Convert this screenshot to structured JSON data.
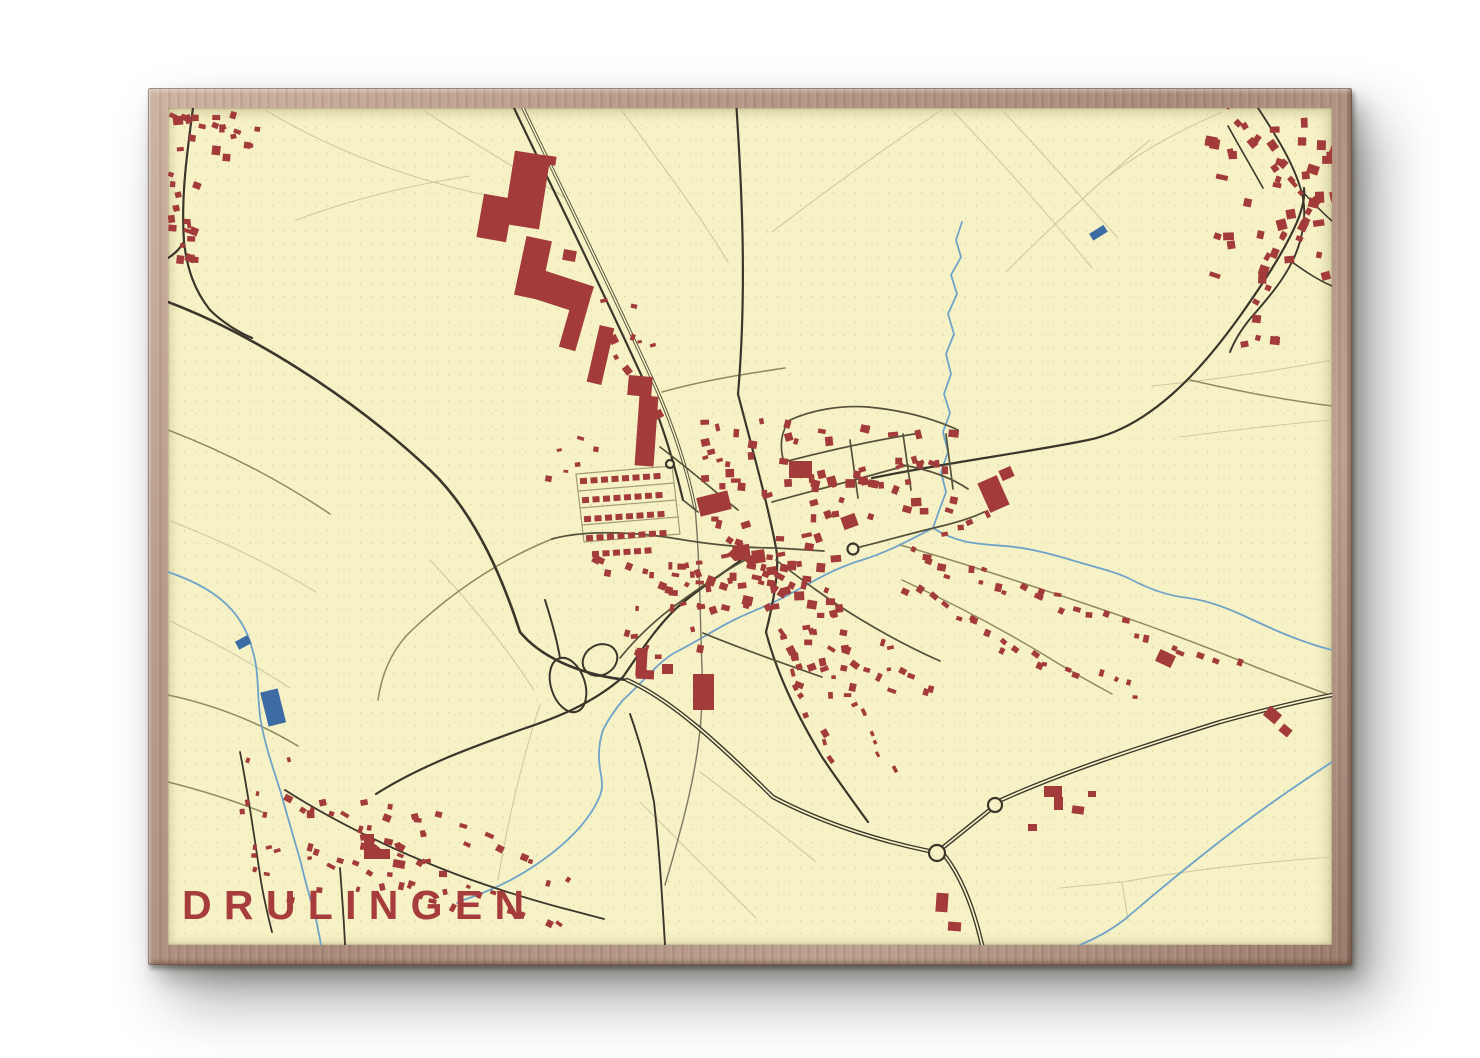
{
  "scene": {
    "background_color": "#ffffff"
  },
  "poster": {
    "title": "DRULINGEN",
    "title_color": "#a63d3c",
    "frame_color": "#b49685",
    "paper_color": "#f6f2c6"
  },
  "map": {
    "colors": {
      "building": "#a23b3a",
      "water": "#6fa3c8",
      "pond": "#3d6ca5",
      "road_major": "#3a362b",
      "road_medium": "#55503a",
      "road_minor": "#8f8a5e",
      "field_line": "#cfc9a0",
      "railway": "#7b7660"
    },
    "building_blocks": [
      {
        "x": 480,
        "y": 196,
        "w": 30,
        "h": 44,
        "r": 10
      },
      {
        "x": 509,
        "y": 153,
        "w": 36,
        "h": 74,
        "r": 9
      },
      {
        "x": 520,
        "y": 238,
        "w": 26,
        "h": 60,
        "r": 12
      },
      {
        "x": 527,
        "y": 276,
        "w": 64,
        "h": 30,
        "r": 18
      },
      {
        "x": 566,
        "y": 296,
        "w": 17,
        "h": 54,
        "r": 16
      },
      {
        "x": 593,
        "y": 326,
        "w": 15,
        "h": 58,
        "r": 13
      },
      {
        "x": 628,
        "y": 376,
        "w": 24,
        "h": 20,
        "r": 5
      },
      {
        "x": 637,
        "y": 396,
        "w": 19,
        "h": 70,
        "r": 4
      },
      {
        "x": 545,
        "y": 156,
        "w": 11,
        "h": 9,
        "r": 8
      },
      {
        "x": 563,
        "y": 250,
        "w": 13,
        "h": 11,
        "r": 10
      },
      {
        "x": 698,
        "y": 494,
        "w": 32,
        "h": 19,
        "r": -14
      },
      {
        "x": 693,
        "y": 674,
        "w": 21,
        "h": 36,
        "r": 0
      },
      {
        "x": 789,
        "y": 461,
        "w": 23,
        "h": 17,
        "r": 0
      },
      {
        "x": 842,
        "y": 515,
        "w": 15,
        "h": 13,
        "r": -20
      },
      {
        "x": 983,
        "y": 478,
        "w": 21,
        "h": 32,
        "r": -24
      },
      {
        "x": 1000,
        "y": 468,
        "w": 13,
        "h": 11,
        "r": -24
      },
      {
        "x": 1157,
        "y": 652,
        "w": 17,
        "h": 13,
        "r": 25
      },
      {
        "x": 1265,
        "y": 709,
        "w": 15,
        "h": 12,
        "r": 40
      },
      {
        "x": 1280,
        "y": 726,
        "w": 11,
        "h": 9,
        "r": 40
      },
      {
        "x": 936,
        "y": 893,
        "w": 12,
        "h": 19,
        "r": 4
      },
      {
        "x": 948,
        "y": 922,
        "w": 13,
        "h": 9,
        "r": 4
      },
      {
        "x": 364,
        "y": 834,
        "w": 10,
        "h": 25,
        "r": 0
      },
      {
        "x": 364,
        "y": 849,
        "w": 26,
        "h": 10,
        "r": 0
      },
      {
        "x": 393,
        "y": 860,
        "w": 12,
        "h": 8,
        "r": 10
      },
      {
        "x": 1044,
        "y": 786,
        "w": 18,
        "h": 11,
        "r": 0
      },
      {
        "x": 1054,
        "y": 797,
        "w": 9,
        "h": 13,
        "r": 0
      },
      {
        "x": 1072,
        "y": 806,
        "w": 12,
        "h": 8,
        "r": 8
      },
      {
        "x": 1028,
        "y": 824,
        "w": 9,
        "h": 7,
        "r": 0
      },
      {
        "x": 1088,
        "y": 791,
        "w": 8,
        "h": 6,
        "r": 0
      },
      {
        "x": 733,
        "y": 545,
        "w": 17,
        "h": 15,
        "r": -8
      },
      {
        "x": 752,
        "y": 550,
        "w": 13,
        "h": 13,
        "r": -8
      },
      {
        "x": 636,
        "y": 648,
        "w": 11,
        "h": 28,
        "r": 3
      },
      {
        "x": 636,
        "y": 670,
        "w": 18,
        "h": 9,
        "r": 3
      },
      {
        "x": 662,
        "y": 664,
        "w": 11,
        "h": 10,
        "r": 0
      }
    ],
    "building_clusters": [
      {
        "x": 170,
        "y": 108,
        "w": 85,
        "h": 55,
        "n": 13,
        "s": 7
      },
      {
        "x": 168,
        "y": 170,
        "w": 38,
        "h": 95,
        "n": 11,
        "s": 6
      },
      {
        "x": 1205,
        "y": 108,
        "w": 140,
        "h": 180,
        "n": 38,
        "s": 8
      },
      {
        "x": 1238,
        "y": 296,
        "w": 55,
        "h": 55,
        "n": 5,
        "s": 7
      },
      {
        "x": 695,
        "y": 468,
        "w": 150,
        "h": 150,
        "n": 65,
        "s": 7
      },
      {
        "x": 700,
        "y": 418,
        "w": 110,
        "h": 52,
        "n": 15,
        "s": 6
      },
      {
        "x": 806,
        "y": 425,
        "w": 155,
        "h": 100,
        "n": 30,
        "s": 7
      },
      {
        "x": 655,
        "y": 545,
        "w": 52,
        "h": 108,
        "n": 13,
        "s": 6
      },
      {
        "x": 782,
        "y": 612,
        "w": 118,
        "h": 88,
        "n": 22,
        "s": 6
      },
      {
        "x": 282,
        "y": 798,
        "w": 180,
        "h": 108,
        "n": 26,
        "s": 6
      },
      {
        "x": 236,
        "y": 756,
        "w": 58,
        "h": 128,
        "n": 12,
        "s": 5
      },
      {
        "x": 618,
        "y": 598,
        "w": 62,
        "h": 62,
        "n": 6,
        "s": 5
      },
      {
        "x": 598,
        "y": 296,
        "w": 62,
        "h": 60,
        "n": 6,
        "s": 5
      },
      {
        "x": 545,
        "y": 435,
        "w": 60,
        "h": 50,
        "n": 6,
        "s": 5
      }
    ],
    "building_strips": [
      {
        "x1": 905,
        "y1": 552,
        "x2": 1055,
        "y2": 600,
        "n": 14,
        "s": 6,
        "j": 8
      },
      {
        "x1": 1055,
        "y1": 600,
        "x2": 1230,
        "y2": 660,
        "n": 12,
        "s": 6,
        "j": 8
      },
      {
        "x1": 905,
        "y1": 585,
        "x2": 1030,
        "y2": 655,
        "n": 12,
        "s": 6,
        "j": 8
      },
      {
        "x1": 1030,
        "y1": 660,
        "x2": 1140,
        "y2": 690,
        "n": 8,
        "s": 5,
        "j": 8
      },
      {
        "x1": 832,
        "y1": 648,
        "x2": 935,
        "y2": 692,
        "n": 9,
        "s": 6,
        "j": 8
      },
      {
        "x1": 770,
        "y1": 612,
        "x2": 828,
        "y2": 755,
        "n": 11,
        "s": 6,
        "j": 9
      },
      {
        "x1": 845,
        "y1": 700,
        "x2": 892,
        "y2": 760,
        "n": 6,
        "s": 5,
        "j": 8
      },
      {
        "x1": 285,
        "y1": 792,
        "x2": 430,
        "y2": 868,
        "n": 12,
        "s": 6,
        "j": 9
      },
      {
        "x1": 300,
        "y1": 848,
        "x2": 465,
        "y2": 903,
        "n": 12,
        "s": 6,
        "j": 9
      },
      {
        "x1": 435,
        "y1": 818,
        "x2": 560,
        "y2": 882,
        "n": 9,
        "s": 6,
        "j": 9
      },
      {
        "x1": 465,
        "y1": 882,
        "x2": 555,
        "y2": 928,
        "n": 7,
        "s": 5,
        "j": 8
      },
      {
        "x1": 172,
        "y1": 112,
        "x2": 252,
        "y2": 128,
        "n": 7,
        "s": 6,
        "j": 7
      },
      {
        "x1": 174,
        "y1": 180,
        "x2": 186,
        "y2": 262,
        "n": 8,
        "s": 5,
        "j": 7
      },
      {
        "x1": 1225,
        "y1": 108,
        "x2": 1302,
        "y2": 195,
        "n": 12,
        "s": 7,
        "j": 10
      },
      {
        "x1": 1302,
        "y1": 200,
        "x2": 1252,
        "y2": 298,
        "n": 11,
        "s": 7,
        "j": 10
      },
      {
        "x1": 585,
        "y1": 555,
        "x2": 690,
        "y2": 585,
        "n": 9,
        "s": 6,
        "j": 8
      },
      {
        "x1": 600,
        "y1": 330,
        "x2": 660,
        "y2": 420,
        "n": 7,
        "s": 6,
        "j": 10
      },
      {
        "x1": 870,
        "y1": 480,
        "x2": 930,
        "y2": 462,
        "n": 5,
        "s": 6,
        "j": 7
      },
      {
        "x1": 720,
        "y1": 540,
        "x2": 792,
        "y2": 590,
        "n": 12,
        "s": 7,
        "j": 9
      },
      {
        "x1": 940,
        "y1": 527,
        "x2": 985,
        "y2": 515,
        "n": 4,
        "s": 6,
        "j": 7
      }
    ],
    "building_rows": [
      {
        "x": 580,
        "y": 478,
        "n": 8,
        "dx": 10.5,
        "slope": -0.7,
        "w": 7,
        "h": 6
      },
      {
        "x": 582,
        "y": 497,
        "n": 8,
        "dx": 10.5,
        "slope": -0.7,
        "w": 7,
        "h": 6
      },
      {
        "x": 584,
        "y": 516,
        "n": 8,
        "dx": 10.5,
        "slope": -0.7,
        "w": 7,
        "h": 6
      },
      {
        "x": 586,
        "y": 535,
        "n": 8,
        "dx": 10.5,
        "slope": -0.7,
        "w": 7,
        "h": 6
      },
      {
        "x": 592,
        "y": 551,
        "n": 6,
        "dx": 10.5,
        "slope": -0.7,
        "w": 7,
        "h": 6
      }
    ]
  }
}
